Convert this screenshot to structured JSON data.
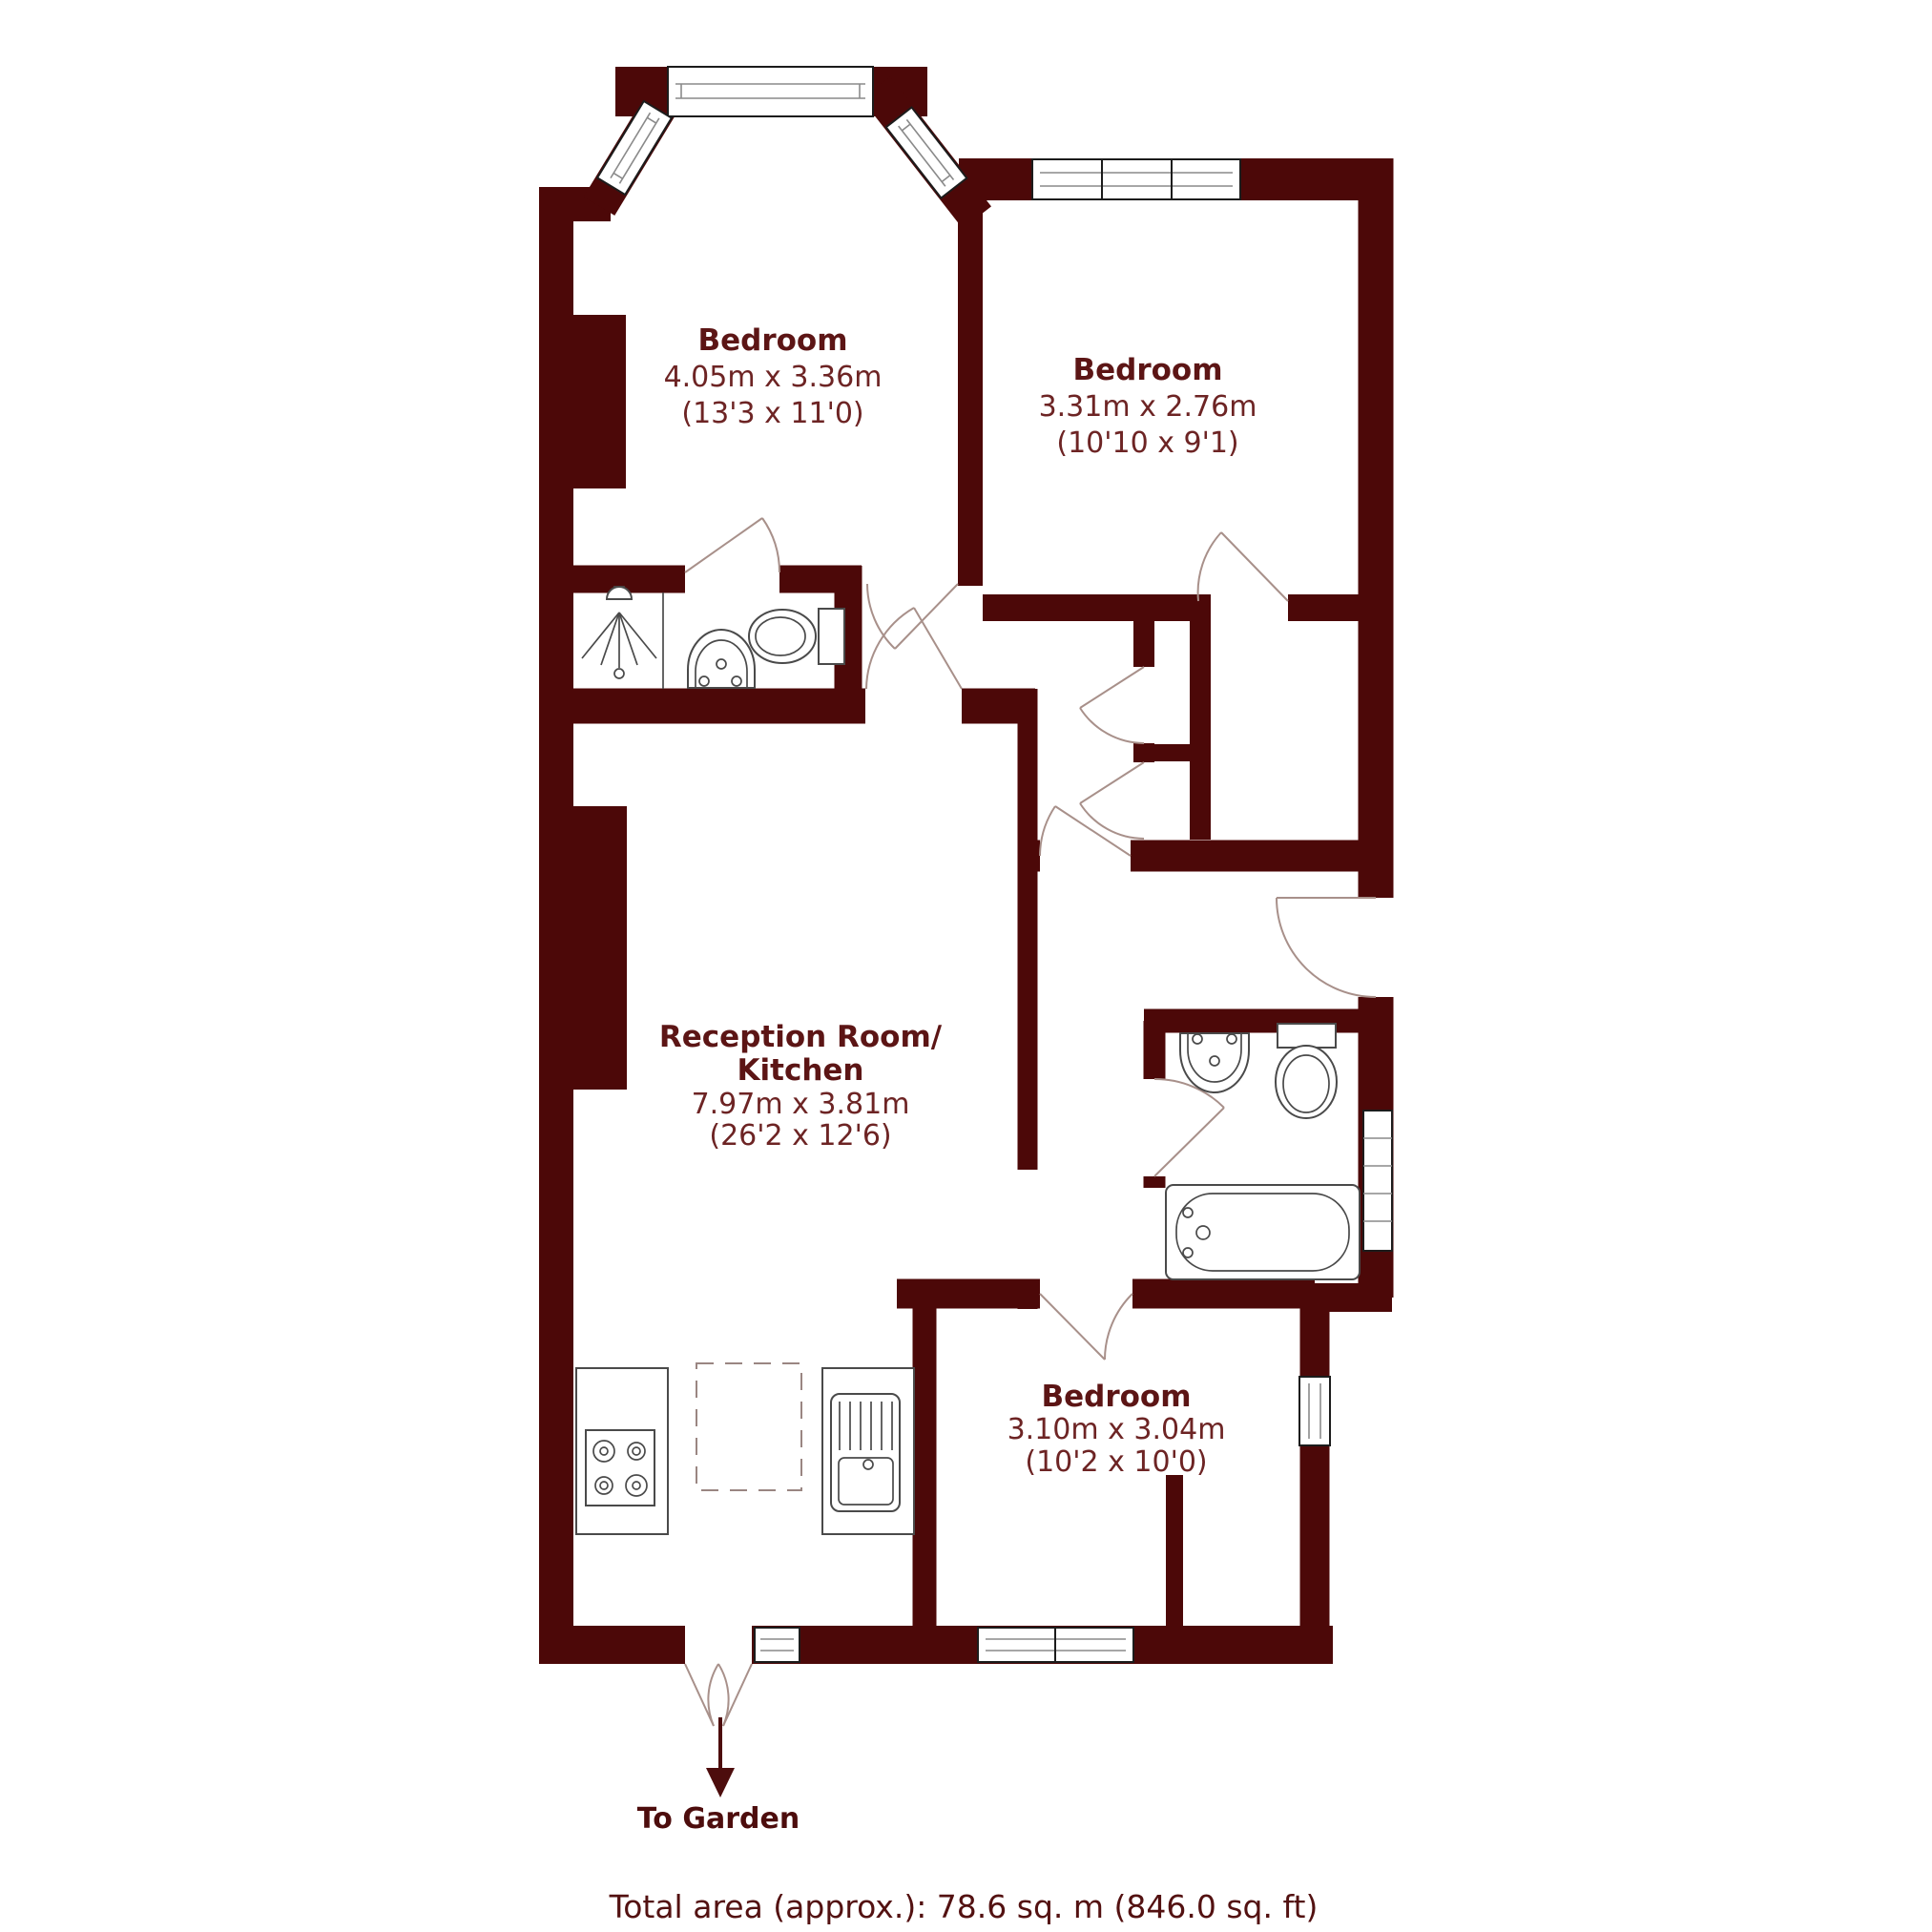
{
  "rooms": [
    {
      "id": "bedroom-1",
      "name": "Bedroom",
      "dims_m": "4.05m x 3.36m",
      "dims_ft": "(13'3 x 11'0)"
    },
    {
      "id": "bedroom-2",
      "name": "Bedroom",
      "dims_m": "3.31m x 2.76m",
      "dims_ft": "(10'10 x 9'1)"
    },
    {
      "id": "reception-kitchen",
      "name_line1": "Reception Room/",
      "name_line2": "Kitchen",
      "dims_m": "7.97m x 3.81m",
      "dims_ft": "(26'2 x 12'6)"
    },
    {
      "id": "bedroom-3",
      "name": "Bedroom",
      "dims_m": "3.10m x 3.04m",
      "dims_ft": "(10'2 x 10'0)"
    }
  ],
  "footer": {
    "to_garden": "To Garden",
    "total_area": "Total area (approx.): 78.6 sq. m (846.0 sq. ft)"
  },
  "icons": {
    "shower": "shower head with spray and drain",
    "toilet_shower_room": "toilet with cistern",
    "basin_shower_room": "wash basin",
    "toilet_bathroom": "toilet with cistern",
    "basin_bathroom": "wash basin",
    "bath": "bath tub with taps",
    "radiator": "towel radiator",
    "hob": "4-ring cooker hob",
    "sink": "kitchen sink with drainer",
    "island": "dashed kitchen island outline",
    "garden_arrow": "down arrow to garden"
  },
  "colors": {
    "wall": "#4c0808",
    "room_name_text": "#5c1515",
    "dimension_text": "#6d2424",
    "door_arc": "#a8908a",
    "fixture_line": "#4a4a4a",
    "background": "#ffffff"
  }
}
